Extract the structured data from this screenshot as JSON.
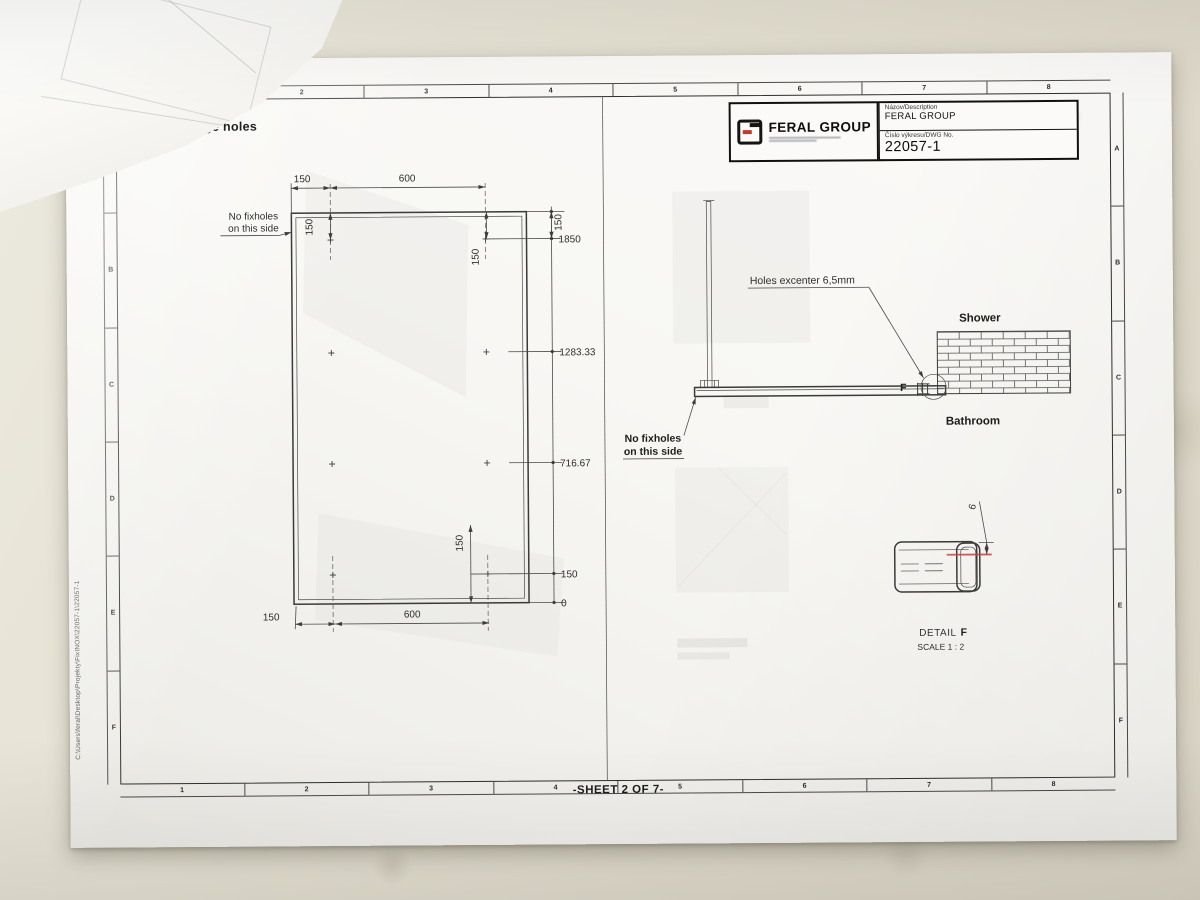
{
  "title_block": {
    "logo_text": "FERAL GROUP",
    "name_label": "Názov/Description",
    "name_value": "FERAL GROUP",
    "dwg_label": "Číslo výkresu/DWG No.",
    "dwg_value": "22057-1",
    "ghost_dwg": "22057-1"
  },
  "border": {
    "columns": [
      "1",
      "2",
      "3",
      "4",
      "5",
      "6",
      "7",
      "8"
    ],
    "rows": [
      "A",
      "B",
      "C",
      "D",
      "E",
      "F"
    ]
  },
  "footer": {
    "sheet_label": "-SHEET 2 OF 7-",
    "file_path": "C:\\Users\\feral\\Desktop\\Projekty\\FixINOX\\22057-1\\22057-1"
  },
  "front_view": {
    "title": "Montage holes",
    "note_line1": "No fixholes",
    "note_line2": "on this side",
    "dim_top_150": "150",
    "dim_top_600": "600",
    "dim_bottom_150": "150",
    "dim_bottom_600": "600",
    "dim_150_top_left": "150",
    "dim_150_top_right": "150",
    "dim_150_top_ordinate": "150",
    "dim_150_bottom_right": "150",
    "ordinates": [
      "1850",
      "1283.33",
      "716.67",
      "150",
      "0"
    ]
  },
  "side_view": {
    "holes_note": "Holes excenter 6,5mm",
    "shower": "Shower",
    "bathroom": "Bathroom",
    "note_line1": "No fixholes",
    "note_line2": "on this side",
    "detail_marker": "F"
  },
  "detail_view": {
    "label": "DETAIL",
    "letter": "F",
    "scale": "SCALE 1 : 2",
    "dim": "6",
    "marker_color": "#c2453e"
  }
}
